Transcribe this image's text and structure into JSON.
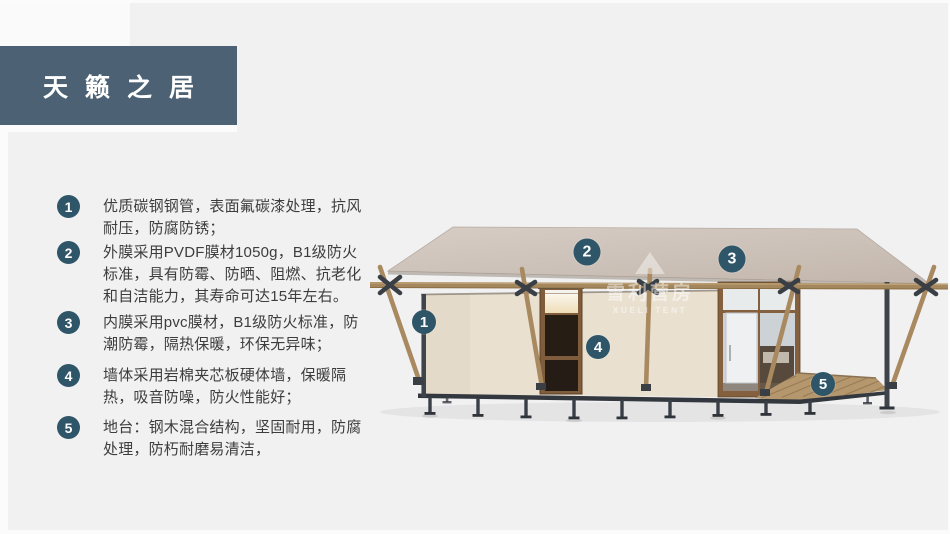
{
  "header": {
    "title": "天籁之居"
  },
  "features": [
    {
      "num": "1",
      "text": "优质碳钢钢管，表面氟碳漆处理，抗风耐压，防腐防锈；"
    },
    {
      "num": "2",
      "text": "外膜采用PVDF膜材1050g，B1级防火标准，具有防霉、防晒、阻燃、抗老化和自洁能力，其寿命可达15年左右。"
    },
    {
      "num": "3",
      "text": "内膜采用pvc膜材，B1级防火标准，防潮防霉，隔热保暖，环保无异味；"
    },
    {
      "num": "4",
      "text": "墙体采用岩棉夹芯板硬体墙，保暖隔热，吸音防噪，防火性能好；"
    },
    {
      "num": "5",
      "text": "地台：钢木混合结构，坚固耐用，防腐处理，防朽耐磨易清洁，"
    }
  ],
  "illustration": {
    "watermark": {
      "cn": "雪利营房",
      "en": "XUELI TENT"
    },
    "markers": [
      {
        "num": "1"
      },
      {
        "num": "2"
      },
      {
        "num": "3"
      },
      {
        "num": "4"
      },
      {
        "num": "5"
      }
    ]
  },
  "colors": {
    "title_box": "#4c6274",
    "badge": "#2e5568",
    "marker": "#2e5568",
    "panel_bg": "#f1f1f2",
    "roof": "#ccc0b6",
    "wall": "#e9e0d0",
    "wood": "#a9895f",
    "door_frame": "#7f5c3b",
    "steel": "#3a3f46",
    "deck": "#b5976e",
    "text": "#3d3d3d"
  }
}
